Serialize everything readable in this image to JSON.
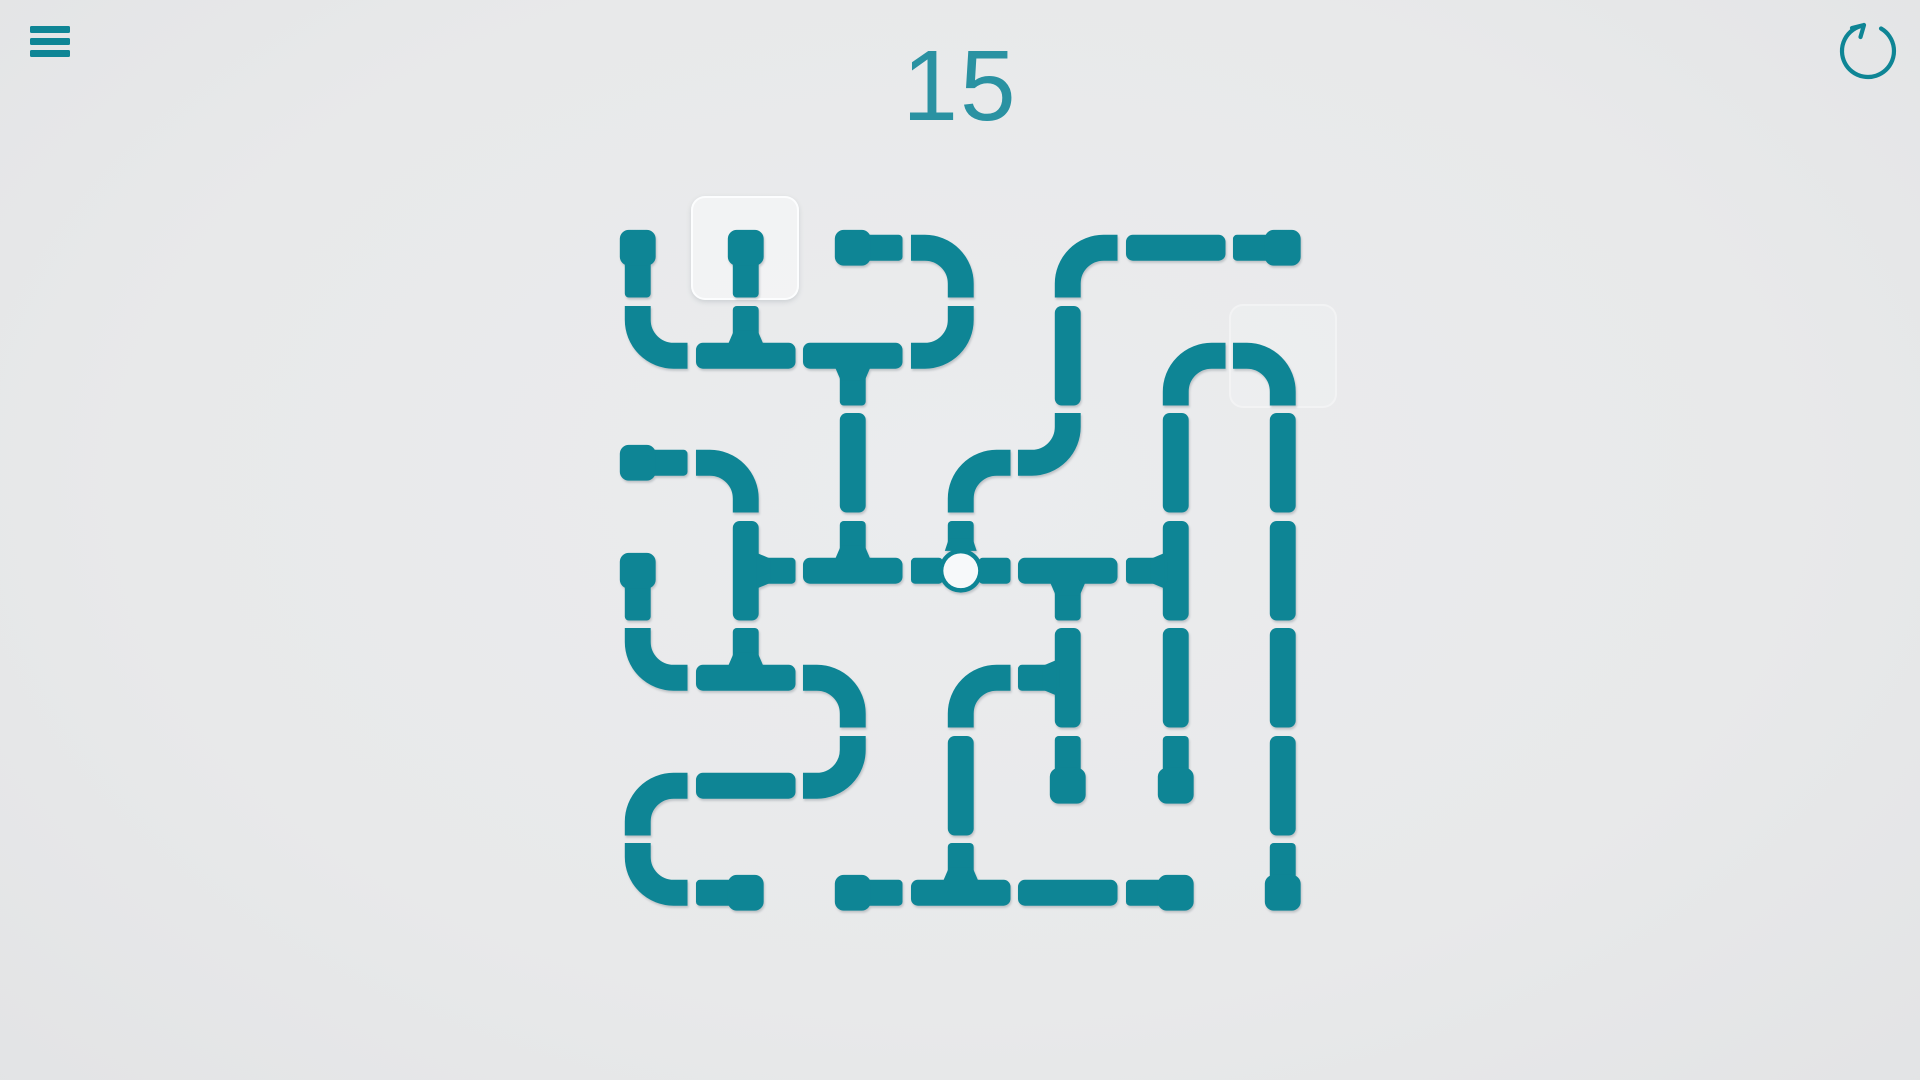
{
  "header": {
    "level": "15",
    "menu_icon": "hamburger-menu-icon",
    "restart_icon": "restart-icon"
  },
  "colors": {
    "pipe": "#0e8595",
    "level_text": "#2a92a2",
    "background": "#e8e9ea",
    "valve_fill": "#f7f9fa",
    "highlight": "#ffffff"
  },
  "grid": {
    "rows": 7,
    "cols": 7,
    "cells": [
      [
        "end-s",
        "end-s",
        "end-e",
        "elbow-ws",
        "elbow-se",
        "str-h",
        "end-w"
      ],
      [
        "elbow-ne",
        "tee-nwe",
        "tee-swe",
        "elbow-nw",
        "str-v",
        "elbow-se",
        "elbow-ws"
      ],
      [
        "end-e",
        "elbow-ws",
        "str-v",
        "elbow-se",
        "elbow-nw",
        "str-v",
        "str-v"
      ],
      [
        "end-s",
        "tee-nse",
        "tee-nwe",
        "valve-nwe",
        "tee-swe",
        "tee-nsw",
        "str-v"
      ],
      [
        "elbow-ne",
        "tee-nwe",
        "elbow-ws",
        "elbow-se",
        "tee-nsw",
        "str-v",
        "str-v"
      ],
      [
        "elbow-se",
        "str-h",
        "elbow-nw",
        "str-v",
        "end-n",
        "end-n",
        "str-v"
      ],
      [
        "elbow-ne",
        "end-w",
        "end-e",
        "tee-nwe",
        "str-h",
        "end-w",
        "end-n"
      ]
    ],
    "highlights": [
      {
        "row": 0,
        "col": 1,
        "style": "strong"
      },
      {
        "row": 1,
        "col": 6,
        "style": "faint"
      }
    ]
  }
}
